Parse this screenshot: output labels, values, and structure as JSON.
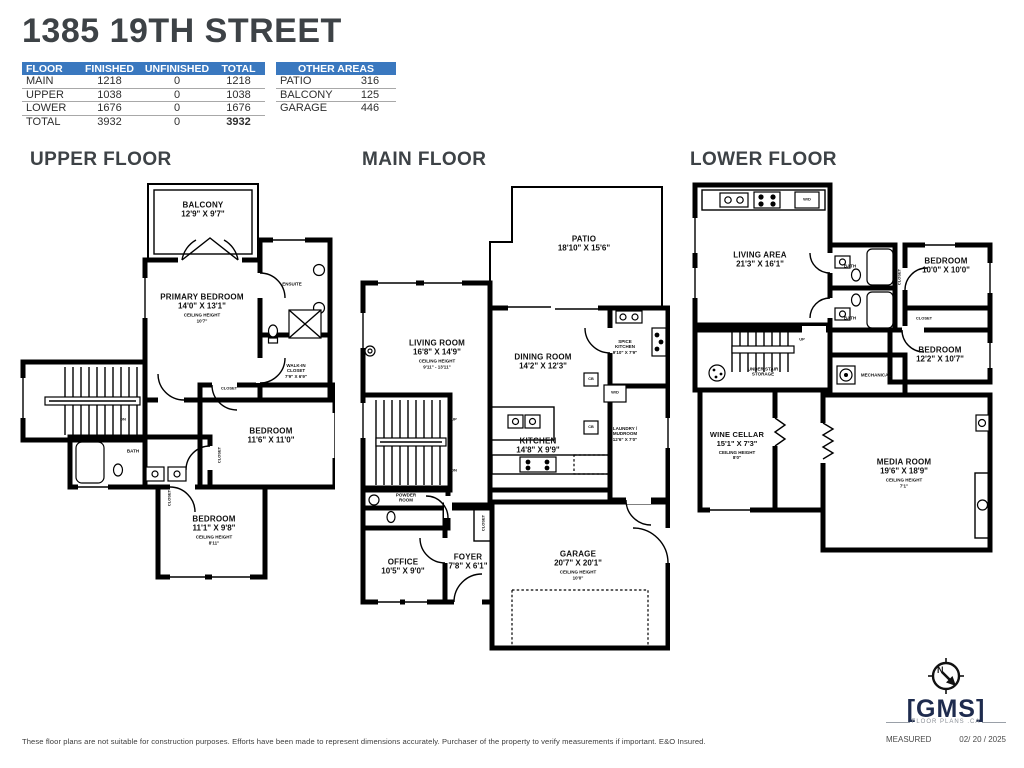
{
  "header": {
    "title": "1385 19TH STREET"
  },
  "area_table": {
    "col_floor": "FLOOR",
    "col_finished": "FINISHED",
    "col_unfinished": "UNFINISHED",
    "col_total": "TOTAL",
    "rows": [
      {
        "floor": "MAIN",
        "finished": "1218",
        "unfinished": "0",
        "total": "1218"
      },
      {
        "floor": "UPPER",
        "finished": "1038",
        "unfinished": "0",
        "total": "1038"
      },
      {
        "floor": "LOWER",
        "finished": "1676",
        "unfinished": "0",
        "total": "1676"
      },
      {
        "floor": "TOTAL",
        "finished": "3932",
        "unfinished": "0",
        "total": "3932"
      }
    ]
  },
  "other_areas": {
    "header": "OTHER AREAS",
    "rows": [
      {
        "name": "PATIO",
        "value": "316"
      },
      {
        "name": "BALCONY",
        "value": "125"
      },
      {
        "name": "GARAGE",
        "value": "446"
      }
    ]
  },
  "labels": {
    "ceiling_height": "CEILING HEIGHT",
    "up": "UP",
    "dn": "DN",
    "closet": "CLOSET",
    "bath": "BATH",
    "wd": "W/D",
    "cb": "CB"
  },
  "floors": {
    "upper": {
      "heading": "UPPER FLOOR",
      "rooms": {
        "balcony": {
          "name": "BALCONY",
          "dims": "12'9\" X 9'7\""
        },
        "primary": {
          "name": "PRIMARY BEDROOM",
          "dims": "14'0\" X 13'1\"",
          "ceiling": "10'7\""
        },
        "ensuite": {
          "name": "ENSUITE"
        },
        "wic": {
          "name": "WALK-IN CLOSET",
          "dims": "7'9\" X 6'9\""
        },
        "bedroom1": {
          "name": "BEDROOM",
          "dims": "11'6\" X 11'0\""
        },
        "bedroom2": {
          "name": "BEDROOM",
          "dims": "11'1\" X 9'8\"",
          "ceiling": "8'11\""
        }
      }
    },
    "main": {
      "heading": "MAIN FLOOR",
      "rooms": {
        "patio": {
          "name": "PATIO",
          "dims": "18'10\" X 15'6\""
        },
        "living": {
          "name": "LIVING ROOM",
          "dims": "16'8\" X 14'9\"",
          "ceiling": "9'11\" - 13'11\""
        },
        "dining": {
          "name": "DINING ROOM",
          "dims": "14'2\" X 12'3\""
        },
        "spice": {
          "name": "SPICE KITCHEN",
          "dims": "9'10\" X 7'9\""
        },
        "kitchen": {
          "name": "KITCHEN",
          "dims": "14'8\" X 9'9\""
        },
        "laundry": {
          "name": "LAUNDRY / MUDROOM",
          "dims": "12'6\" X 7'0\""
        },
        "powder": {
          "name": "POWDER ROOM"
        },
        "office": {
          "name": "OFFICE",
          "dims": "10'5\" X 9'0\""
        },
        "foyer": {
          "name": "FOYER",
          "dims": "7'8\" X 6'1\""
        },
        "garage": {
          "name": "GARAGE",
          "dims": "20'7\" X 20'1\"",
          "ceiling": "10'0\""
        }
      }
    },
    "lower": {
      "heading": "LOWER FLOOR",
      "rooms": {
        "living_area": {
          "name": "LIVING AREA",
          "dims": "21'3\" X 16'1\""
        },
        "bedroom1": {
          "name": "BEDROOM",
          "dims": "10'0\" X 10'0\""
        },
        "bedroom2": {
          "name": "BEDROOM",
          "dims": "12'2\" X 10'7\""
        },
        "understair": {
          "name": "UNDER STAIR STORAGE"
        },
        "mechanical": {
          "name": "MECHANICAL"
        },
        "wine": {
          "name": "WINE CELLAR",
          "dims": "15'1\" X 7'3\"",
          "ceiling": "8'0\""
        },
        "media": {
          "name": "MEDIA ROOM",
          "dims": "19'6\" X 18'9\"",
          "ceiling": "7'1\""
        }
      }
    }
  },
  "footer": {
    "disclaimer": "These floor plans are not suitable for construction purposes. Efforts have been made to represent dimensions accurately.  Purchaser of the property to verify measurements if important.  E&O Insured.",
    "measured_label": "MEASURED",
    "measured_date": "02/ 20 / 2025"
  },
  "logo": {
    "bracket_left": "[",
    "brand": "GMS",
    "bracket_right": "]",
    "tagline": "FLOOR PLANS .CA"
  },
  "colors": {
    "table_header_blue": "#3a78bf",
    "heading_dark": "#3d4246",
    "logo_navy": "#1e2b4e",
    "walls": "#000000"
  }
}
